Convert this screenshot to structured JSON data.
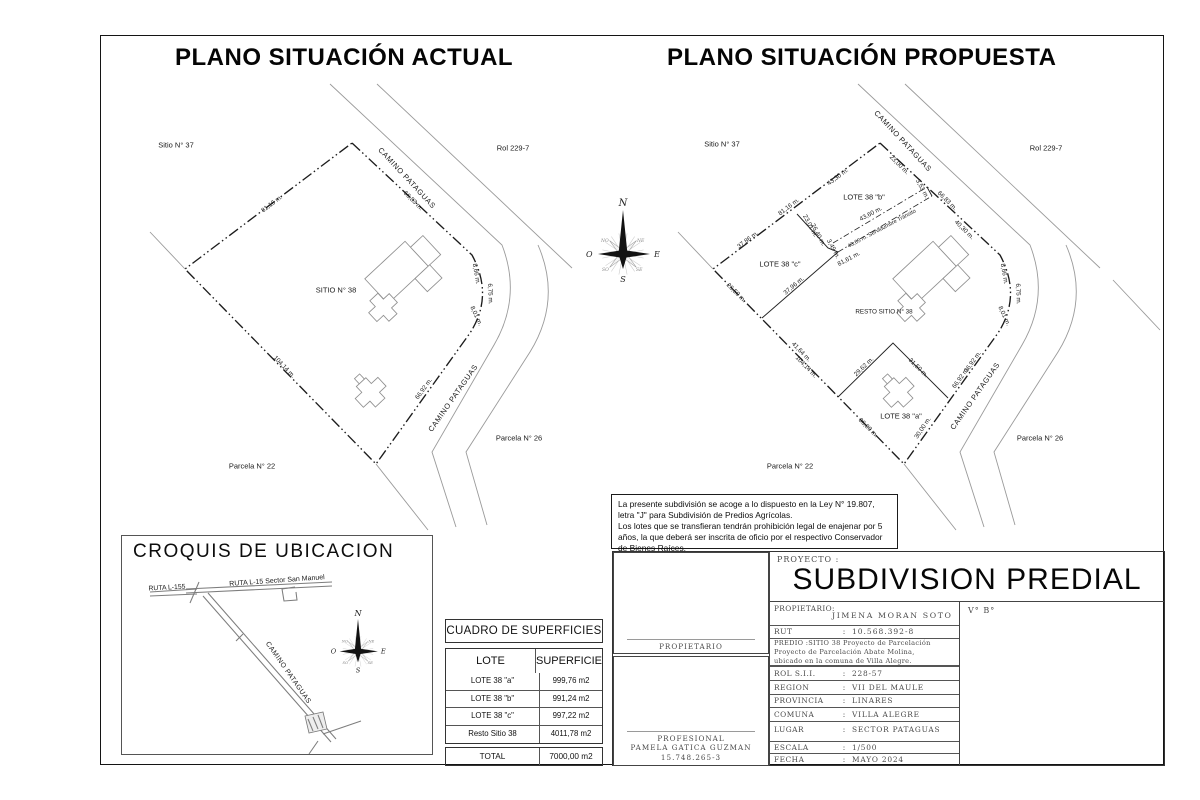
{
  "colors": {
    "boundary": "#1c1c1c",
    "road": "#9a9a9a",
    "building": "#8f8f8f",
    "cad_text": "#4a4a4a"
  },
  "plan_actual": {
    "title": "PLANO SITUACIÓN ACTUAL",
    "labels": [
      {
        "t": "Sitio N° 37",
        "x": 176,
        "y": 145,
        "fs": 7.5
      },
      {
        "t": "CAMINO PATAGUAS",
        "x": 407,
        "y": 178,
        "r": 47,
        "fs": 7.5,
        "ls": 0.6
      },
      {
        "t": "Rol 229-7",
        "x": 513,
        "y": 148,
        "fs": 7.5
      },
      {
        "t": "81,16 m.",
        "x": 272,
        "y": 204,
        "r": -37
      },
      {
        "t": "66,83 m.",
        "x": 413,
        "y": 201,
        "r": 45
      },
      {
        "t": "8,66 m.",
        "x": 476,
        "y": 274,
        "r": 80
      },
      {
        "t": "6,75 m.",
        "x": 490,
        "y": 294,
        "r": 88
      },
      {
        "t": "8,01 m.",
        "x": 476,
        "y": 316,
        "r": 65
      },
      {
        "t": "SITIO N° 38",
        "x": 336,
        "y": 290,
        "fs": 7.5
      },
      {
        "t": "104,14 m.",
        "x": 284,
        "y": 367,
        "r": 46
      },
      {
        "t": "66,92 m.",
        "x": 424,
        "y": 389,
        "r": -54
      },
      {
        "t": "CAMINO PATAGUAS",
        "x": 453,
        "y": 398,
        "r": -55,
        "fs": 7.5,
        "ls": 0.6
      },
      {
        "t": "Parcela N° 26",
        "x": 519,
        "y": 438,
        "fs": 7.5
      },
      {
        "t": "Parcela N° 22",
        "x": 252,
        "y": 466,
        "fs": 7.5
      }
    ]
  },
  "plan_propuesta": {
    "title": "PLANO SITUACIÓN PROPUESTA",
    "labels": [
      {
        "t": "Sitio N° 37",
        "x": 722,
        "y": 144,
        "fs": 7.5
      },
      {
        "t": "CAMINO PATAGUAS",
        "x": 903,
        "y": 141,
        "r": 47,
        "fs": 7.5,
        "ls": 0.6
      },
      {
        "t": "Rol 229-7",
        "x": 1046,
        "y": 148,
        "fs": 7.5
      },
      {
        "t": "23,00 m.",
        "x": 899,
        "y": 165,
        "r": 45
      },
      {
        "t": "43,30 m.",
        "x": 838,
        "y": 177,
        "r": -37
      },
      {
        "t": "81,16 m.",
        "x": 789,
        "y": 207,
        "r": -37
      },
      {
        "t": "37,86 m.",
        "x": 748,
        "y": 240,
        "r": -37
      },
      {
        "t": "LOTE 38 \"b\"",
        "x": 864,
        "y": 197,
        "fs": 7.5
      },
      {
        "t": "23,01 m.",
        "x": 810,
        "y": 226,
        "r": 62
      },
      {
        "t": "26,40 m.",
        "x": 818,
        "y": 235,
        "r": 62
      },
      {
        "t": "43,60 m.",
        "x": 871,
        "y": 214,
        "r": -28
      },
      {
        "t": "43,65 m.  Servidumbre Tránsito",
        "x": 882,
        "y": 229,
        "r": -28,
        "fs": 5.6
      },
      {
        "t": "3,53 m.",
        "x": 922,
        "y": 189,
        "r": 62
      },
      {
        "t": "66,83 m.",
        "x": 947,
        "y": 201,
        "r": 45
      },
      {
        "t": "40,30 m.",
        "x": 964,
        "y": 230,
        "r": 45
      },
      {
        "t": "3,49 m.",
        "x": 833,
        "y": 249,
        "r": 62
      },
      {
        "t": "81,61 m.",
        "x": 849,
        "y": 259,
        "r": -28
      },
      {
        "t": "LOTE 38 \"c\"",
        "x": 780,
        "y": 264,
        "fs": 7.5
      },
      {
        "t": "26,50 m.",
        "x": 736,
        "y": 293,
        "r": 45
      },
      {
        "t": "37,96 m.",
        "x": 794,
        "y": 286,
        "r": -40
      },
      {
        "t": "RESTO SITIO N° 38",
        "x": 884,
        "y": 312,
        "fs": 6.3
      },
      {
        "t": "8,66 m.",
        "x": 1004,
        "y": 274,
        "r": 80
      },
      {
        "t": "6,75 m.",
        "x": 1018,
        "y": 294,
        "r": 88
      },
      {
        "t": "8,01 m.",
        "x": 1004,
        "y": 316,
        "r": 65
      },
      {
        "t": "41,64 m.",
        "x": 801,
        "y": 352,
        "r": 46
      },
      {
        "t": "104,14 m.",
        "x": 806,
        "y": 367,
        "r": 46
      },
      {
        "t": "29,62 m.",
        "x": 864,
        "y": 367,
        "r": -44
      },
      {
        "t": "31,50 m.",
        "x": 918,
        "y": 368,
        "r": 45
      },
      {
        "t": "LOTE 38 \"a\"",
        "x": 901,
        "y": 416,
        "fs": 7.5
      },
      {
        "t": "36,00 m.",
        "x": 868,
        "y": 428,
        "r": 45
      },
      {
        "t": "30,00 m.",
        "x": 923,
        "y": 428,
        "r": -56
      },
      {
        "t": "36,92 m.",
        "x": 973,
        "y": 362,
        "r": -54
      },
      {
        "t": "66,92 m.",
        "x": 961,
        "y": 378,
        "r": -54
      },
      {
        "t": "CAMINO PATAGUAS",
        "x": 975,
        "y": 396,
        "r": -55,
        "fs": 7.5,
        "ls": 0.6
      },
      {
        "t": "Parcela N° 26",
        "x": 1040,
        "y": 438,
        "fs": 7.5
      },
      {
        "t": "Parcela N° 22",
        "x": 790,
        "y": 466,
        "fs": 7.5
      }
    ]
  },
  "compass": {
    "n": "N",
    "s": "S",
    "e": "E",
    "o": "O",
    "ne": "NE",
    "se": "SE",
    "so": "SO",
    "no": "NO"
  },
  "legal_note": {
    "line1": "La presente subdivisión se acoge a lo dispuesto en la Ley N° 19.807, letra \"J\" para Subdivisión de Predios Agrícolas.",
    "line2": "Los lotes que se transfieran tendrán prohibición legal de enajenar por 5 años, la que deberá ser inscrita de oficio por el respectivo Conservador de Bienes Raíces."
  },
  "croquis": {
    "title": "CROQUIS DE UBICACION",
    "labels": [
      {
        "t": "RUTA L-155",
        "x": 167,
        "y": 588,
        "r": -3,
        "fs": 6.8
      },
      {
        "t": "RUTA L-15 Sector San Manuel",
        "x": 277,
        "y": 581,
        "r": -4,
        "fs": 7
      },
      {
        "t": "CAMINO PATAGUAS",
        "x": 288,
        "y": 673,
        "r": 55,
        "fs": 7,
        "ls": 0.5
      }
    ]
  },
  "surface_table": {
    "title": "CUADRO DE SUPERFICIES",
    "col_lote": "LOTE",
    "col_superficie": "SUPERFICIE",
    "rows": [
      {
        "lote": "LOTE 38 \"a\"",
        "sup": "999,76 m2"
      },
      {
        "lote": "LOTE 38 \"b\"",
        "sup": "991,24 m2"
      },
      {
        "lote": "LOTE 38 \"c\"",
        "sup": "997,22 m2"
      },
      {
        "lote": "Resto Sitio 38",
        "sup": "4011,78 m2"
      }
    ],
    "total_label": "TOTAL",
    "total_value": "7000,00 m2"
  },
  "title_block": {
    "proyecto_label": "PROYECTO :",
    "proyecto": "SUBDIVISION PREDIAL",
    "vb": "V° B°",
    "propietario_label": "PROPIETARIO:",
    "propietario": "JIMENA MORAN SOTO",
    "rut_label": "RUT",
    "sep": ":",
    "rut": "10.568.392-8",
    "predio_lines": [
      "PREDIO :SITIO 38 Proyecto de Parcelación",
      "Proyecto de Parcelación Abate Molina,",
      "ubicado en la comuna de Villa Alegre."
    ],
    "rows": [
      {
        "label": "ROL S.I.I.",
        "sep": ":",
        "value": "228-57"
      },
      {
        "label": "REGION",
        "sep": ":",
        "value": "VII DEL MAULE"
      },
      {
        "label": "PROVINCIA",
        "sep": ":",
        "value": "LINARES"
      },
      {
        "label": "COMUNA",
        "sep": ":",
        "value": "VILLA ALEGRE"
      },
      {
        "label": "LUGAR",
        "sep": ":",
        "value": "SECTOR PATAGUAS"
      }
    ],
    "rows2": [
      {
        "label": "ESCALA",
        "sep": ":",
        "value": "1/500"
      },
      {
        "label": "FECHA",
        "sep": ":",
        "value": "MAYO 2024"
      }
    ],
    "firma1": "PROPIETARIO",
    "firma2_lines": [
      "PROFESIONAL",
      "PAMELA GATICA GUZMAN",
      "15.748.265-3"
    ]
  }
}
